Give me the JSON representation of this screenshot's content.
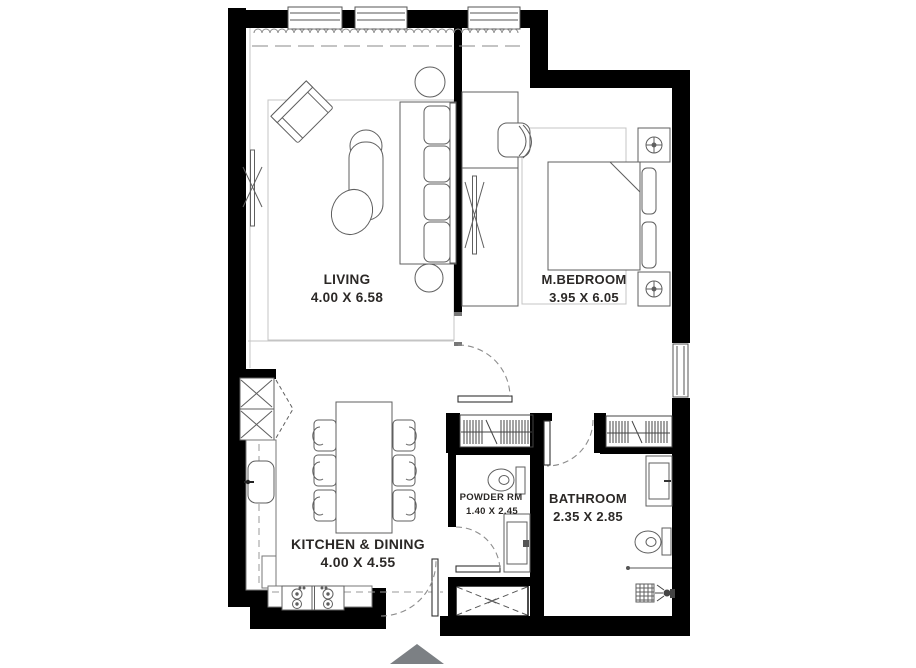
{
  "plan_title": "apartment-floor-plan",
  "rooms": {
    "living": {
      "name": "LIVING",
      "dims": "4.00 X 6.58"
    },
    "bedroom": {
      "name": "M.BEDROOM",
      "dims": "3.95 X 6.05"
    },
    "kitchen": {
      "name": "KITCHEN & DINING",
      "dims": "4.00 X 4.55"
    },
    "powder": {
      "name": "POWDER RM",
      "dims": "1.40 X 2.45"
    },
    "bathroom": {
      "name": "BATHROOM",
      "dims": "2.35 X 2.85"
    }
  },
  "colors": {
    "wall": "#000000",
    "furniture_line": "#5f5f5f",
    "light_line": "#c4c4c4",
    "text": "#2b2826",
    "entry_arrow": "#7c8084",
    "background": "#ffffff"
  }
}
